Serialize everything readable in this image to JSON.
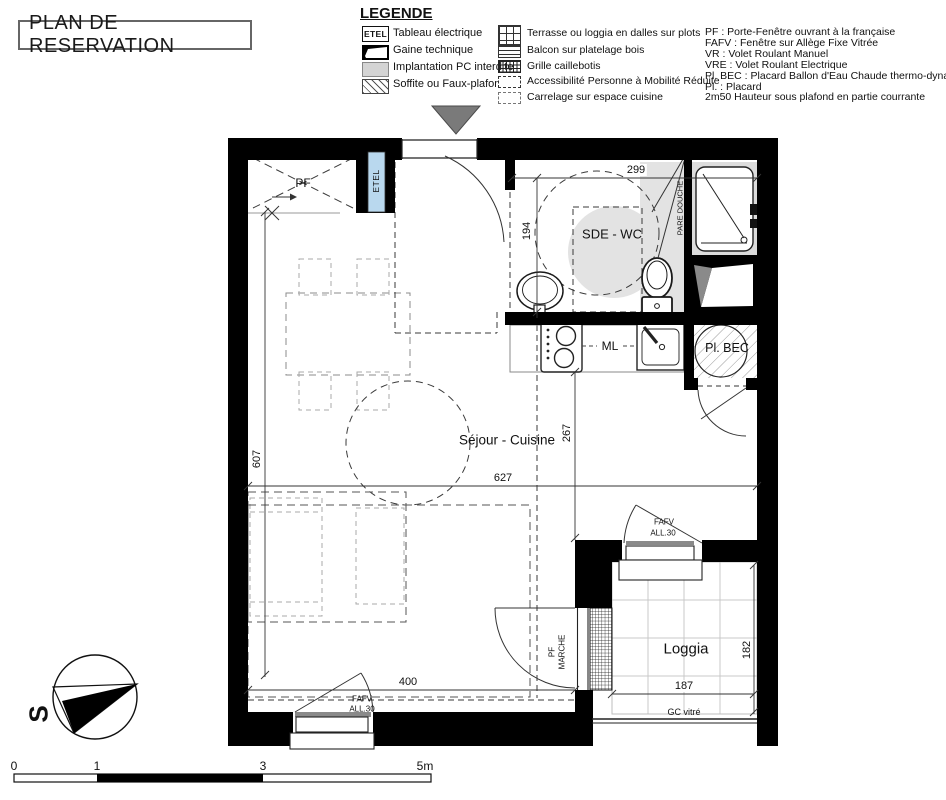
{
  "title": "PLAN DE RESERVATION",
  "legend": {
    "heading": "LEGENDE",
    "col1": [
      {
        "icon": "etel-box",
        "icon_text": "ETEL",
        "label": "Tableau électrique"
      },
      {
        "icon": "gaine-technique",
        "label": "Gaine technique"
      },
      {
        "icon": "pc-interdite",
        "label": "Implantation PC interdite"
      },
      {
        "icon": "soffite-hatch",
        "label": "Soffite ou Faux-plafond"
      }
    ],
    "col2": [
      {
        "icon": "dalles-grid",
        "label": "Terrasse ou loggia en dalles sur plots"
      },
      {
        "icon": "platelage-stripes",
        "label": "Balcon sur platelage bois"
      },
      {
        "icon": "caillebotis-grid",
        "label": "Grille caillebotis"
      },
      {
        "icon": "pmr-dashed",
        "label": "Accessibilité Personne à Mobilité Réduite"
      },
      {
        "icon": "carrelage-dashed",
        "label": "Carrelage sur espace cuisine"
      }
    ],
    "abbreviations": [
      "PF : Porte-Fenêtre ouvrant à la française",
      "FAFV : Fenêtre sur Allège Fixe Vitrée",
      "VR : Volet Roulant Manuel",
      "VRE : Volet Roulant Electrique",
      "Pl. BEC : Placard Ballon d'Eau Chaude thermo-dynamique",
      "Pl. : Placard",
      "2m50 Hauteur sous plafond en partie courrante"
    ]
  },
  "plan": {
    "rooms": {
      "sde_wc": "SDE - WC",
      "sejour_cuisine": "Séjour - Cuisine",
      "loggia": "Loggia",
      "pl_bec": "Pl. BEC"
    },
    "labels": {
      "pf": "PF",
      "etel": "ETEL",
      "pare_douche": "PARE DOUCHE",
      "ml": "ML",
      "gc_vitre": "GC vitré",
      "pf_marche_line1": "PF",
      "pf_marche_line2": "MARCHE",
      "fafv": "FAFV",
      "all30": "ALL.30"
    },
    "dimensions": {
      "d299": "299",
      "d194": "194",
      "d267": "267",
      "d627": "627",
      "d607": "607",
      "d400": "400",
      "d187": "187",
      "d182": "182"
    }
  },
  "compass": {
    "letter": "S"
  },
  "scale_bar": {
    "ticks": [
      "0",
      "1",
      "3",
      "5m"
    ]
  }
}
